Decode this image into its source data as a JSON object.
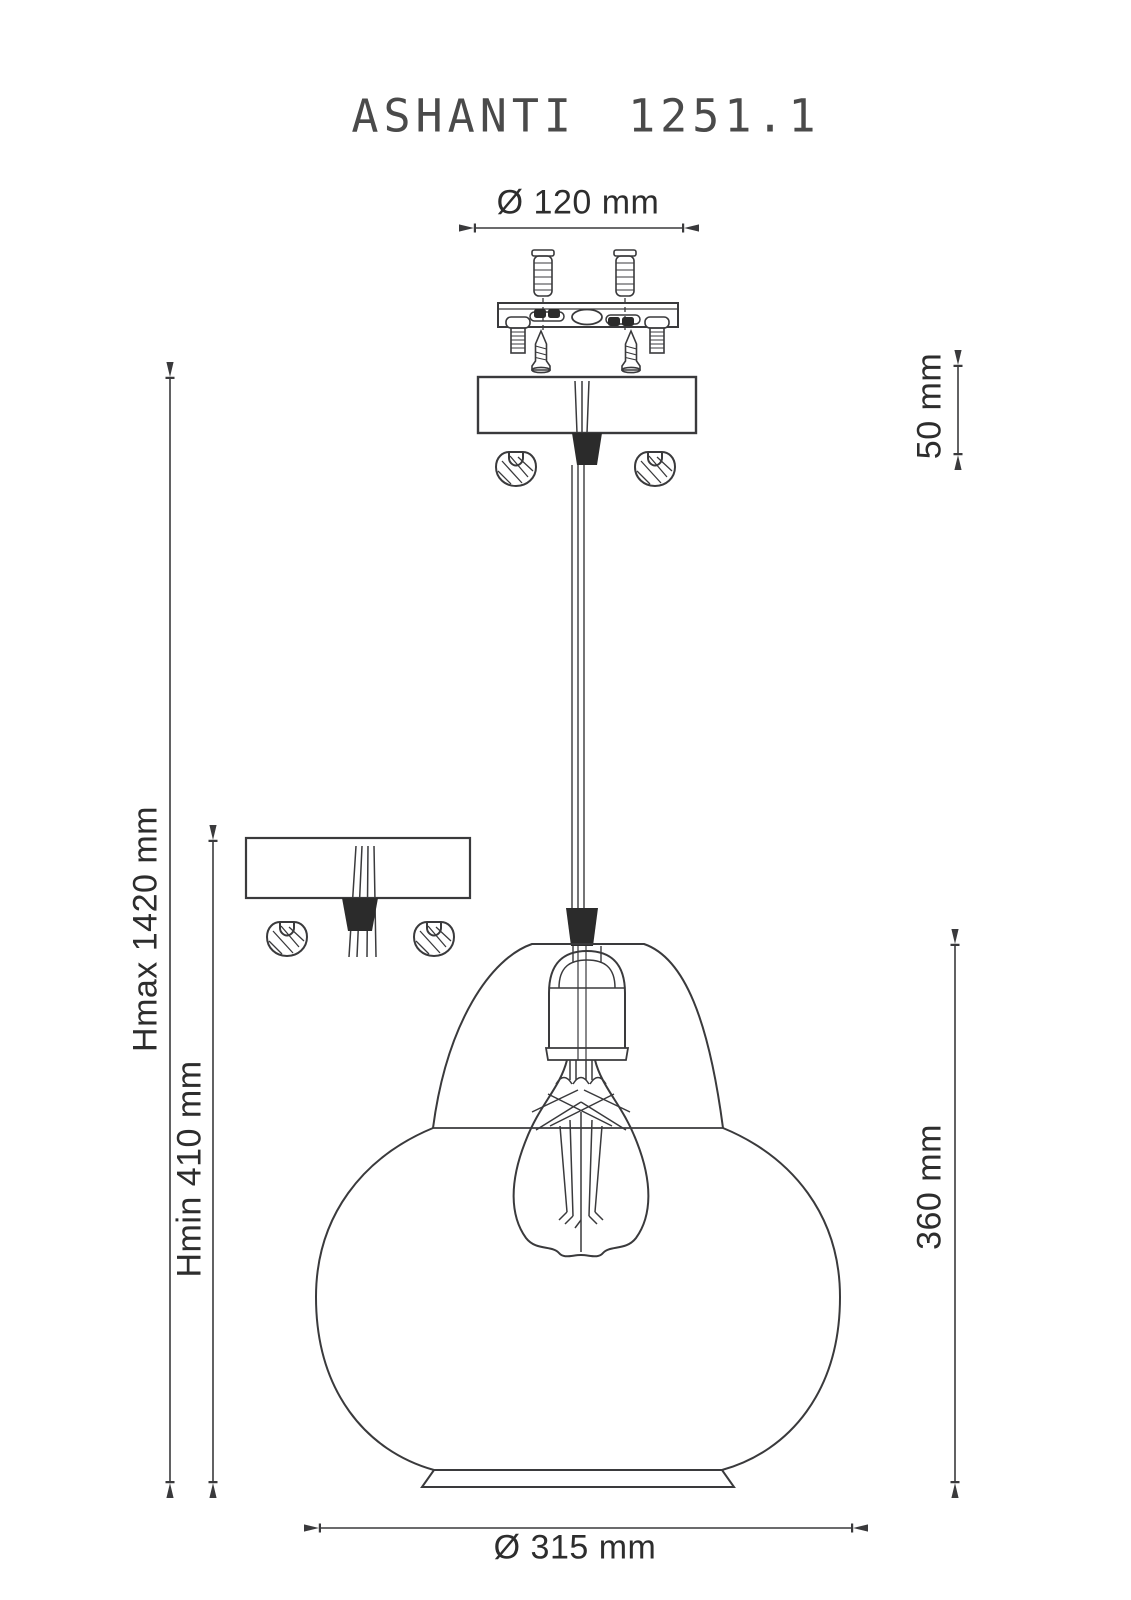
{
  "title": "ASHANTI 1251.1",
  "colors": {
    "background": "#ffffff",
    "line": "#3a3a3c",
    "dark_fill": "#2b2b2b",
    "text": "#2d2d2d"
  },
  "dimensions": {
    "canopy_diameter": "Ø 120 mm",
    "canopy_height": "50 mm",
    "height_max": "Hmax 1420 mm",
    "height_min": "Hmin 410 mm",
    "shade_height": "360 mm",
    "shade_diameter": "Ø 315 mm"
  },
  "drawing_parts": [
    "wall-anchors",
    "mounting-plate-with-screws",
    "machine-bolts",
    "wood-screws",
    "ceiling-canopy-front-view",
    "ceiling-canopy-side-view",
    "cord-grips",
    "dome-nuts",
    "suspension-cable",
    "lamp-socket",
    "edison-bulb-with-filament",
    "glass-shade",
    "shade-base-ring"
  ]
}
